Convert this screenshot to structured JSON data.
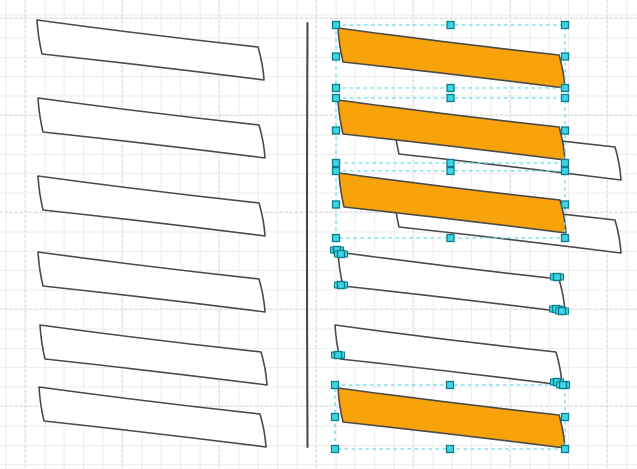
{
  "canvas": {
    "width": 637,
    "height": 469,
    "background": "#ffffff"
  },
  "grid": {
    "minor_spacing": 19.4,
    "major_spacing": 97,
    "major_offset_x": 25,
    "major_offset_y": 18,
    "minor_color": "#ededed",
    "major_color": "#d7d7d7"
  },
  "colors": {
    "shape_stroke": "#4a4a4a",
    "orange_fill": "#f9a30b",
    "white_fill": "#ffffff",
    "selection_dash": "#63dcec",
    "handle_fill": "#3ed5e5",
    "handle_border": "#0d7d8c",
    "divider": "#454545"
  },
  "divider": {
    "x": 307.5,
    "y_top": 23,
    "y_bottom": 447
  },
  "shapes": [
    {
      "id": "left-shape-1",
      "fill": "white",
      "x": 37,
      "y": 20
    },
    {
      "id": "left-shape-2",
      "fill": "white",
      "x": 38,
      "y": 98
    },
    {
      "id": "left-shape-3",
      "fill": "white",
      "x": 38,
      "y": 176
    },
    {
      "id": "left-shape-4",
      "fill": "white",
      "x": 38,
      "y": 252
    },
    {
      "id": "left-shape-5",
      "fill": "white",
      "x": 40,
      "y": 325
    },
    {
      "id": "left-shape-6",
      "fill": "white",
      "x": 39,
      "y": 387
    },
    {
      "id": "right-white-behind-2",
      "fill": "white",
      "x": 394,
      "y": 120
    },
    {
      "id": "right-white-behind-3",
      "fill": "white",
      "x": 394,
      "y": 193
    },
    {
      "id": "right-orange-1",
      "fill": "orange",
      "x": 338,
      "y": 28
    },
    {
      "id": "right-orange-2",
      "fill": "orange",
      "x": 338,
      "y": 100
    },
    {
      "id": "right-orange-3",
      "fill": "orange",
      "x": 339,
      "y": 173
    },
    {
      "id": "right-white-4",
      "fill": "white",
      "x": 338,
      "y": 252
    },
    {
      "id": "right-white-5",
      "fill": "white",
      "x": 335,
      "y": 325
    },
    {
      "id": "right-orange-6",
      "fill": "orange",
      "x": 338,
      "y": 388
    }
  ],
  "selection_boxes": [
    {
      "x": 336,
      "y": 25,
      "w": 229,
      "h": 63
    },
    {
      "x": 336,
      "y": 98,
      "w": 229,
      "h": 65
    },
    {
      "x": 336,
      "y": 171,
      "w": 229,
      "h": 67
    },
    {
      "x": 335,
      "y": 385,
      "w": 230,
      "h": 64
    }
  ],
  "terminal_handles": [
    {
      "x": 337,
      "y": 250
    },
    {
      "x": 341,
      "y": 254
    },
    {
      "x": 341,
      "y": 285
    },
    {
      "x": 557,
      "y": 277
    },
    {
      "x": 556,
      "y": 309
    },
    {
      "x": 562,
      "y": 311
    },
    {
      "x": 338,
      "y": 355
    },
    {
      "x": 557,
      "y": 382
    },
    {
      "x": 563,
      "y": 385
    }
  ]
}
